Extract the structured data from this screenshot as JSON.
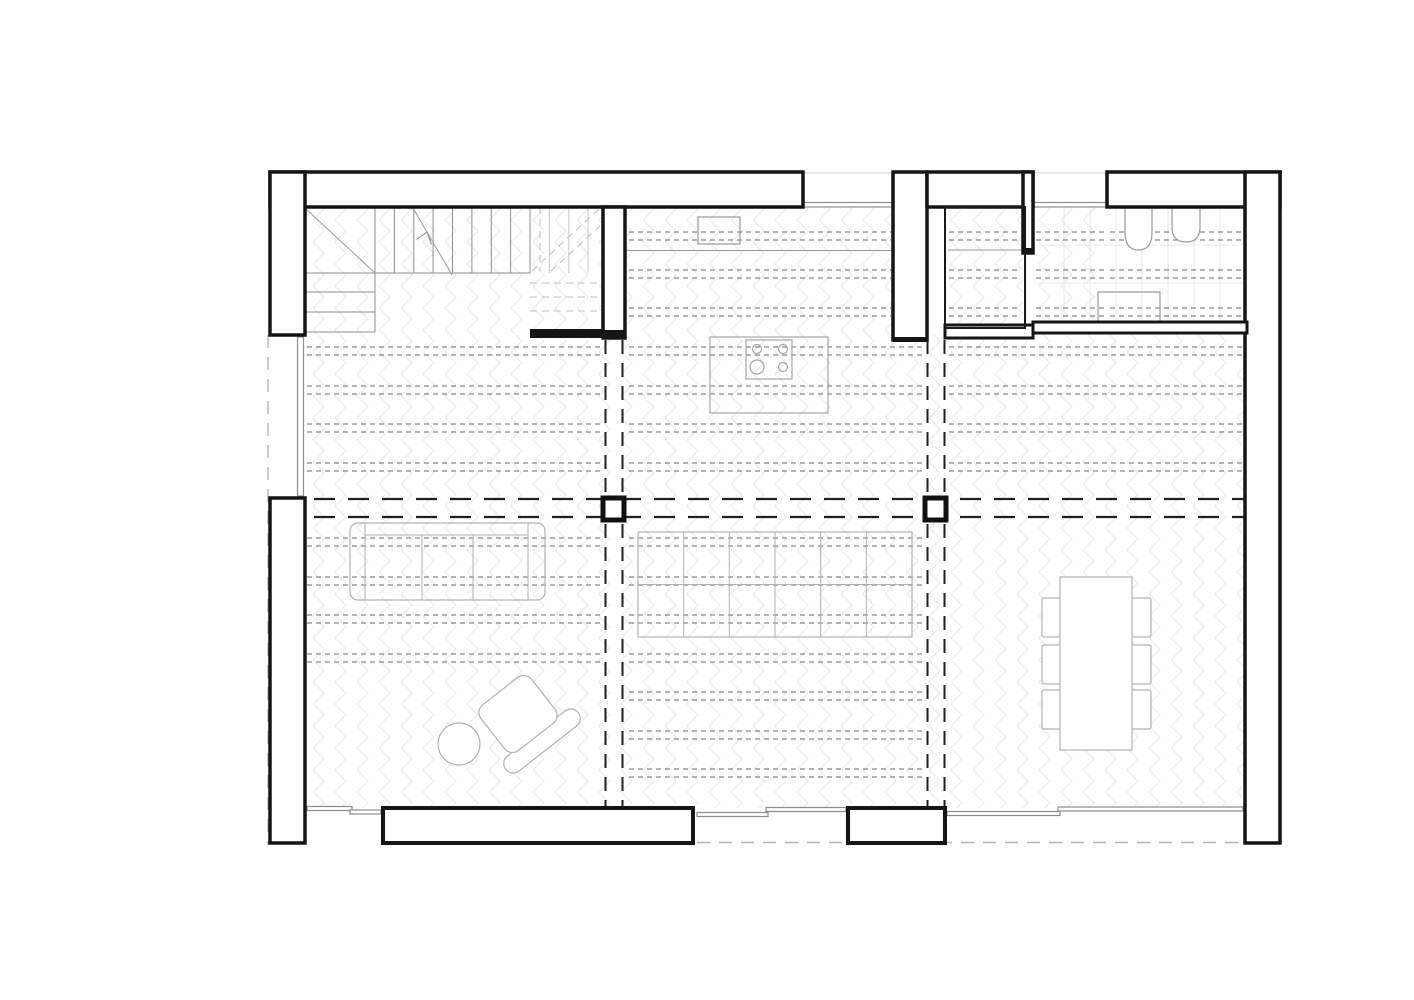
{
  "meta": {
    "type": "architectural-floor-plan",
    "view": "ground-floor",
    "background": "#ffffff"
  },
  "canvas": {
    "w": 1414,
    "h": 1000
  },
  "colors": {
    "wall_stroke": "#151515",
    "wall_fill": "#ffffff",
    "solid_fill": "#151515",
    "joist": "#6a6a6a",
    "beam": "#1f1f1f",
    "above_dash": "#b5b5b5",
    "stair": "#8f8f8f",
    "stair_light": "#c9c9c9",
    "landing_dash": "#bdbdbd",
    "furniture": "#b2b2b2",
    "fixture": "#9a9a9a",
    "island": "#a6a6a6",
    "window_frame": "#8c8c8c",
    "tile_grid": "#e3e3e3",
    "floor_pattern": "#ebebeb"
  },
  "plan": {
    "shapes": [
      {
        "t": "floor",
        "n": "floor-living",
        "x": 305,
        "y": 335,
        "w": 940,
        "h": 473
      },
      {
        "t": "floor",
        "n": "floor-kitchen",
        "x": 627,
        "y": 207,
        "w": 266,
        "h": 130
      },
      {
        "t": "floor",
        "n": "floor-stair",
        "x": 305,
        "y": 207,
        "w": 298,
        "h": 127
      },
      {
        "t": "floor",
        "n": "floor-wc",
        "x": 947,
        "y": 210,
        "w": 76,
        "h": 116
      },
      {
        "t": "floor",
        "n": "floor-hall",
        "x": 1036,
        "y": 207,
        "w": 69,
        "h": 114
      },
      {
        "t": "grid",
        "n": "bath-tile-grid",
        "x": 1038,
        "y": 207,
        "w": 205,
        "h": 115,
        "step": 26,
        "hy": [
          245,
          283
        ],
        "c": "#e3e3e3"
      },
      {
        "t": "joist",
        "n": "joists-left",
        "x1": 307,
        "x2": 600,
        "c": [
          351,
          390,
          428,
          467,
          542,
          581,
          619,
          658
        ]
      },
      {
        "t": "joist",
        "n": "joists-kitchen",
        "x1": 629,
        "x2": 891,
        "c": [
          236,
          274,
          312
        ]
      },
      {
        "t": "joist",
        "n": "joists-mid",
        "x1": 629,
        "x2": 923,
        "c": [
          351,
          390,
          428,
          467,
          542,
          581,
          619,
          658,
          696,
          735,
          773
        ]
      },
      {
        "t": "joist",
        "n": "joists-right",
        "x1": 949,
        "x2": 1243,
        "c": [
          351,
          390,
          428,
          467
        ]
      },
      {
        "t": "joist",
        "n": "joists-bath",
        "x1": 1110,
        "x2": 1243,
        "c": [
          236,
          274,
          312
        ]
      },
      {
        "t": "joist",
        "n": "joists-hall",
        "x1": 1036,
        "x2": 1105,
        "c": [
          236,
          274,
          312
        ]
      },
      {
        "t": "joist",
        "n": "joists-wc",
        "x1": 949,
        "x2": 1021,
        "c": [
          236,
          274,
          312
        ]
      },
      {
        "t": "line",
        "n": "beam-line-h1",
        "x1": 280,
        "y1": 499,
        "x2": 1245,
        "y2": 499,
        "c": "#1f1f1f",
        "w": 2.2,
        "dash": "21 13"
      },
      {
        "t": "line",
        "n": "beam-line-h2",
        "x1": 280,
        "y1": 517,
        "x2": 1245,
        "y2": 517,
        "c": "#1f1f1f",
        "w": 2.2,
        "dash": "21 13"
      },
      {
        "t": "line",
        "n": "beam-line-v1",
        "x1": 605.5,
        "y1": 340,
        "x2": 605.5,
        "y2": 806,
        "c": "#1f1f1f",
        "w": 2,
        "dash": "14 9"
      },
      {
        "t": "line",
        "n": "beam-line-v2",
        "x1": 622.5,
        "y1": 340,
        "x2": 622.5,
        "y2": 806,
        "c": "#1f1f1f",
        "w": 2,
        "dash": "14 9"
      },
      {
        "t": "line",
        "n": "beam-line-v3",
        "x1": 927.5,
        "y1": 340,
        "x2": 927.5,
        "y2": 806,
        "c": "#1f1f1f",
        "w": 2,
        "dash": "14 9"
      },
      {
        "t": "line",
        "n": "beam-line-v4",
        "x1": 944.5,
        "y1": 340,
        "x2": 944.5,
        "y2": 806,
        "c": "#1f1f1f",
        "w": 2,
        "dash": "14 9"
      },
      {
        "t": "line",
        "n": "above-edge-left",
        "x1": 268,
        "y1": 335,
        "x2": 268,
        "y2": 845,
        "c": "#b5b5b5",
        "w": 1.4,
        "dash": "13 9"
      },
      {
        "t": "line",
        "n": "above-edge-bottom",
        "x1": 697,
        "y1": 842.5,
        "x2": 1280,
        "y2": 842.5,
        "c": "#b5b5b5",
        "w": 1.4,
        "dash": "13 9"
      },
      {
        "t": "vlines",
        "n": "stair-tread",
        "xs": [
          375,
          394.4,
          413.8,
          433.1,
          452.5,
          471.9,
          491.3,
          510.6,
          530
        ],
        "y1": 207,
        "y2": 273,
        "c": "#8f8f8f"
      },
      {
        "t": "vlines",
        "n": "stair-tread-upper",
        "xs": [
          549.4,
          568.8,
          588.1
        ],
        "y1": 207,
        "y2": 273,
        "c": "#c9c9c9"
      },
      {
        "t": "line",
        "n": "stair-base-line",
        "x1": 305,
        "y1": 273,
        "x2": 530,
        "y2": 273,
        "c": "#8f8f8f"
      },
      {
        "t": "hlines",
        "n": "stair-winder-tread",
        "ys": [
          292,
          312,
          332
        ],
        "x1": 305,
        "x2": 375,
        "c": "#8f8f8f"
      },
      {
        "t": "line",
        "n": "stair-flight-edge",
        "x1": 375,
        "y1": 273,
        "x2": 375,
        "y2": 332,
        "c": "#8f8f8f"
      },
      {
        "t": "line",
        "n": "stair-break-diagonal",
        "x1": 305,
        "y1": 208,
        "x2": 375,
        "y2": 273,
        "c": "#9a9a9a"
      },
      {
        "t": "line",
        "n": "stair-direction-line",
        "x1": 452,
        "y1": 275,
        "x2": 413,
        "y2": 208,
        "c": "#9a9a9a"
      },
      {
        "t": "path",
        "n": "stair-arrow-head",
        "d": "M427,232 L431.5,244.5 M427,232 L416.5,239.5",
        "c": "#9a9a9a",
        "f": "none"
      },
      {
        "t": "line",
        "n": "stair-above-diag-1",
        "x1": 532,
        "y1": 271,
        "x2": 599,
        "y2": 209,
        "c": "#bdbdbd",
        "dash": "7 5"
      },
      {
        "t": "line",
        "n": "stair-above-diag-2",
        "x1": 551,
        "y1": 271,
        "x2": 600,
        "y2": 226,
        "c": "#bdbdbd",
        "dash": "7 5"
      },
      {
        "t": "hlines",
        "n": "stair-above-tread",
        "ys": [
          283,
          297,
          311
        ],
        "x1": 530,
        "x2": 600,
        "c": "#bdbdbd",
        "dash": "7 5"
      },
      {
        "t": "line",
        "n": "stair-above-edge",
        "x1": 540,
        "y1": 207,
        "x2": 540,
        "y2": 271,
        "c": "#bdbdbd",
        "dash": "7 5"
      },
      {
        "t": "rect",
        "n": "lounge-chair-back",
        "x": 496,
        "y": 731.5,
        "w": 92,
        "h": 19,
        "rx": 9.5,
        "f": "#ffffff",
        "c": "#b2b2b2",
        "tr": "rotate(-38 542 741)"
      },
      {
        "t": "rect",
        "n": "lounge-chair-seat",
        "x": 486,
        "y": 685,
        "w": 64,
        "h": 58,
        "rx": 10,
        "f": "#ffffff",
        "c": "#b2b2b2",
        "tr": "rotate(-38 518 714)"
      },
      {
        "t": "circle",
        "n": "pouf",
        "cx": 459,
        "cy": 744,
        "r": 21,
        "f": "#ffffff",
        "c": "#b2b2b2"
      },
      {
        "t": "rect",
        "n": "sofa",
        "x": 350,
        "y": 523,
        "w": 195,
        "h": 77,
        "rx": 8,
        "f": "none",
        "c": "#b2b2b2"
      },
      {
        "t": "vlines",
        "n": "sofa-armrest",
        "xs": [
          365,
          528
        ],
        "y1": 523,
        "y2": 600,
        "c": "#b2b2b2"
      },
      {
        "t": "line",
        "n": "sofa-back-line",
        "x1": 365,
        "y1": 535,
        "x2": 528,
        "y2": 535,
        "c": "#b2b2b2"
      },
      {
        "t": "vlines",
        "n": "sofa-seat-divider",
        "xs": [
          422,
          473
        ],
        "y1": 535,
        "y2": 600,
        "c": "#b2b2b2"
      },
      {
        "t": "rect",
        "n": "work-table",
        "x": 638,
        "y": 532,
        "w": 274,
        "h": 105,
        "f": "none",
        "c": "#b2b2b2"
      },
      {
        "t": "vlines",
        "n": "work-table-divider",
        "xs": [
          683.7,
          729.3,
          775,
          820.7,
          866.3
        ],
        "y1": 532,
        "y2": 637,
        "c": "#b2b2b2"
      },
      {
        "t": "line",
        "n": "work-table-midline",
        "x1": 638,
        "y1": 584.5,
        "x2": 912,
        "y2": 584.5,
        "c": "#b2b2b2"
      },
      {
        "t": "rect",
        "n": "dining-chair",
        "x": 1042,
        "y": 598,
        "w": 21,
        "h": 39,
        "rx": 2,
        "f": "#ffffff",
        "c": "#b2b2b2"
      },
      {
        "t": "rect",
        "n": "dining-chair",
        "x": 1042,
        "y": 645,
        "w": 21,
        "h": 39,
        "rx": 2,
        "f": "#ffffff",
        "c": "#b2b2b2"
      },
      {
        "t": "rect",
        "n": "dining-chair",
        "x": 1042,
        "y": 690,
        "w": 21,
        "h": 39,
        "rx": 2,
        "f": "#ffffff",
        "c": "#b2b2b2"
      },
      {
        "t": "rect",
        "n": "dining-chair",
        "x": 1130,
        "y": 598,
        "w": 21,
        "h": 39,
        "rx": 2,
        "f": "#ffffff",
        "c": "#b2b2b2"
      },
      {
        "t": "rect",
        "n": "dining-chair",
        "x": 1130,
        "y": 645,
        "w": 21,
        "h": 39,
        "rx": 2,
        "f": "#ffffff",
        "c": "#b2b2b2"
      },
      {
        "t": "rect",
        "n": "dining-chair",
        "x": 1130,
        "y": 690,
        "w": 21,
        "h": 39,
        "rx": 2,
        "f": "#ffffff",
        "c": "#b2b2b2"
      },
      {
        "t": "rect",
        "n": "dining-table",
        "x": 1060,
        "y": 577,
        "w": 72,
        "h": 173,
        "f": "#ffffff",
        "c": "#b2b2b2"
      },
      {
        "t": "line",
        "n": "kitchen-counter-edge",
        "x1": 625,
        "y1": 250.5,
        "x2": 893,
        "y2": 250.5,
        "c": "#9a9a9a"
      },
      {
        "t": "rect",
        "n": "kitchen-sink",
        "x": 698,
        "y": 217,
        "w": 42,
        "h": 27,
        "f": "none",
        "c": "#9a9a9a"
      },
      {
        "t": "rect",
        "n": "kitchen-island",
        "x": 710,
        "y": 337,
        "w": 118,
        "h": 76,
        "f": "none",
        "c": "#a6a6a6"
      },
      {
        "t": "rect",
        "n": "cooktop",
        "x": 746,
        "y": 340,
        "w": 46,
        "h": 39,
        "f": "none",
        "c": "#a6a6a6"
      },
      {
        "t": "circle",
        "n": "burner",
        "cx": 757,
        "cy": 349,
        "r": 4.5,
        "f": "none",
        "c": "#a6a6a6"
      },
      {
        "t": "circle",
        "n": "burner",
        "cx": 783,
        "cy": 349,
        "r": 4.5,
        "f": "none",
        "c": "#a6a6a6"
      },
      {
        "t": "circle",
        "n": "burner",
        "cx": 757,
        "cy": 367,
        "r": 7,
        "f": "none",
        "c": "#a6a6a6"
      },
      {
        "t": "circle",
        "n": "burner",
        "cx": 783,
        "cy": 367,
        "r": 4.5,
        "f": "none",
        "c": "#a6a6a6"
      },
      {
        "t": "line",
        "n": "wc-counter-line",
        "x1": 948,
        "y1": 250,
        "x2": 1022,
        "y2": 250,
        "c": "#9a9a9a"
      },
      {
        "t": "path",
        "n": "toilet",
        "d": "M1125,207 L1125,232 Q1125,250 1138.5,250 Q1152,250 1152,232 L1152,207",
        "f": "#ffffff",
        "c": "#9a9a9a"
      },
      {
        "t": "path",
        "n": "bath-sink",
        "d": "M1172,207 L1172,227 Q1172,242 1186,242 Q1200,242 1200,227 L1200,207",
        "f": "#ffffff",
        "c": "#9a9a9a"
      },
      {
        "t": "path",
        "n": "shower",
        "d": "M1098,325 L1098,292 L1160,292 L1160,325",
        "f": "none",
        "c": "#9a9a9a"
      },
      {
        "t": "line",
        "n": "window-face-line",
        "x1": 803,
        "y1": 173,
        "x2": 893,
        "y2": 173,
        "c": "#d4d4d4"
      },
      {
        "t": "line",
        "n": "window-face-line",
        "x1": 1033,
        "y1": 173,
        "x2": 1107,
        "y2": 173,
        "c": "#d4d4d4"
      },
      {
        "t": "rect",
        "n": "window-top-1",
        "x": 803,
        "y": 202.5,
        "w": 90,
        "h": 4.5,
        "f": "#ffffff",
        "c": "#8c8c8c"
      },
      {
        "t": "rect",
        "n": "window-top-2",
        "x": 1033,
        "y": 202.5,
        "w": 74,
        "h": 4.5,
        "f": "#ffffff",
        "c": "#8c8c8c"
      },
      {
        "t": "rect",
        "n": "window-left",
        "x": 297.5,
        "y": 337,
        "w": 6,
        "h": 159,
        "f": "#ffffff",
        "c": "#8c8c8c"
      },
      {
        "t": "rect",
        "n": "window-bottom-1a",
        "x": 307,
        "y": 806.5,
        "w": 45,
        "h": 4,
        "f": "#ffffff",
        "c": "#8c8c8c"
      },
      {
        "t": "rect",
        "n": "window-bottom-1b",
        "x": 350,
        "y": 810,
        "w": 31,
        "h": 4,
        "f": "#ffffff",
        "c": "#8c8c8c"
      },
      {
        "t": "rect",
        "n": "sliding-door-panel-a",
        "x": 697,
        "y": 812.5,
        "w": 71,
        "h": 4,
        "f": "#ffffff",
        "c": "#8c8c8c"
      },
      {
        "t": "rect",
        "n": "sliding-door-panel-b",
        "x": 766,
        "y": 807.5,
        "w": 80,
        "h": 4,
        "f": "#ffffff",
        "c": "#8c8c8c"
      },
      {
        "t": "rect",
        "n": "window-bottom-3a",
        "x": 947,
        "y": 811.5,
        "w": 113,
        "h": 4,
        "f": "#ffffff",
        "c": "#8c8c8c"
      },
      {
        "t": "rect",
        "n": "window-bottom-3b",
        "x": 1058,
        "y": 807,
        "w": 185,
        "h": 4,
        "f": "#ffffff",
        "c": "#8c8c8c"
      },
      {
        "t": "rect",
        "n": "wall-top-left",
        "x": 270,
        "y": 172,
        "w": 533,
        "h": 35,
        "f": "#ffffff",
        "c": "#151515",
        "sw": 3.5
      },
      {
        "t": "rect",
        "n": "wall-kitchen-right",
        "x": 893,
        "y": 172,
        "w": 34,
        "h": 168,
        "f": "#ffffff",
        "c": "#151515",
        "sw": 3.5
      },
      {
        "t": "rect",
        "n": "wall-top-mid",
        "x": 927,
        "y": 172,
        "w": 106,
        "h": 35,
        "f": "#ffffff",
        "c": "#151515",
        "sw": 3.5
      },
      {
        "t": "rect",
        "n": "wall-bath-top",
        "x": 1107,
        "y": 172,
        "w": 173,
        "h": 35,
        "f": "#ffffff",
        "c": "#151515",
        "sw": 3.5
      },
      {
        "t": "rect",
        "n": "wall-right",
        "x": 1245,
        "y": 172,
        "w": 35,
        "h": 671,
        "f": "#ffffff",
        "c": "#151515",
        "sw": 3.5
      },
      {
        "t": "rect",
        "n": "wall-left-upper",
        "x": 270,
        "y": 172,
        "w": 35,
        "h": 163,
        "f": "#ffffff",
        "c": "#151515",
        "sw": 3.5
      },
      {
        "t": "rect",
        "n": "wall-left-lower",
        "x": 270,
        "y": 498,
        "w": 35,
        "h": 345,
        "f": "#ffffff",
        "c": "#151515",
        "sw": 3.5
      },
      {
        "t": "rect",
        "n": "wall-stair-divider",
        "x": 603,
        "y": 207,
        "w": 22,
        "h": 131,
        "f": "#ffffff",
        "c": "#151515",
        "sw": 3.5
      },
      {
        "t": "rect",
        "n": "wall-wc-right-stub",
        "x": 1023,
        "y": 172,
        "w": 10,
        "h": 81,
        "f": "#ffffff",
        "c": "#151515",
        "sw": 3.5
      },
      {
        "t": "rect",
        "n": "wall-wc-bottom",
        "x": 945,
        "y": 325,
        "w": 88,
        "h": 13,
        "f": "#ffffff",
        "c": "#151515",
        "sw": 3
      },
      {
        "t": "rect",
        "n": "wall-bath-bottom",
        "x": 1033,
        "y": 322,
        "w": 214,
        "h": 11,
        "f": "#ffffff",
        "c": "#151515",
        "sw": 3
      },
      {
        "t": "rect",
        "n": "wall-bottom-block-left",
        "x": 383,
        "y": 808,
        "w": 310,
        "h": 35,
        "f": "#ffffff",
        "c": "#151515",
        "sw": 4
      },
      {
        "t": "rect",
        "n": "wall-bottom-block-right",
        "x": 848,
        "y": 808,
        "w": 97,
        "h": 35,
        "f": "#ffffff",
        "c": "#151515",
        "sw": 4
      },
      {
        "t": "rect",
        "n": "wall-stair-stub-solid",
        "x": 530,
        "y": 329,
        "w": 73,
        "h": 9,
        "f": "#151515",
        "c": "none"
      },
      {
        "t": "rect",
        "n": "wall-divider-cap-solid",
        "x": 603,
        "y": 330,
        "w": 22,
        "h": 8,
        "f": "#151515",
        "c": "none"
      },
      {
        "t": "rect",
        "n": "wall-kitchen-cap-solid",
        "x": 893,
        "y": 337,
        "w": 34,
        "h": 5,
        "f": "#151515",
        "c": "none"
      },
      {
        "t": "rect",
        "n": "wall-wc-stub-cap-solid",
        "x": 1023,
        "y": 248,
        "w": 10,
        "h": 5,
        "f": "#151515",
        "c": "none"
      },
      {
        "t": "rect",
        "n": "wc-partition",
        "x": 945,
        "y": 207,
        "w": 80,
        "h": 121,
        "f": "none",
        "c": "#1a1a1a",
        "sw": 2
      },
      {
        "t": "rect",
        "n": "column",
        "x": 603,
        "y": 498,
        "w": 21,
        "h": 22,
        "f": "#ffffff",
        "c": "#111111",
        "sw": 5
      },
      {
        "t": "rect",
        "n": "column",
        "x": 925,
        "y": 498,
        "w": 21,
        "h": 22,
        "f": "#ffffff",
        "c": "#111111",
        "sw": 5
      }
    ]
  }
}
